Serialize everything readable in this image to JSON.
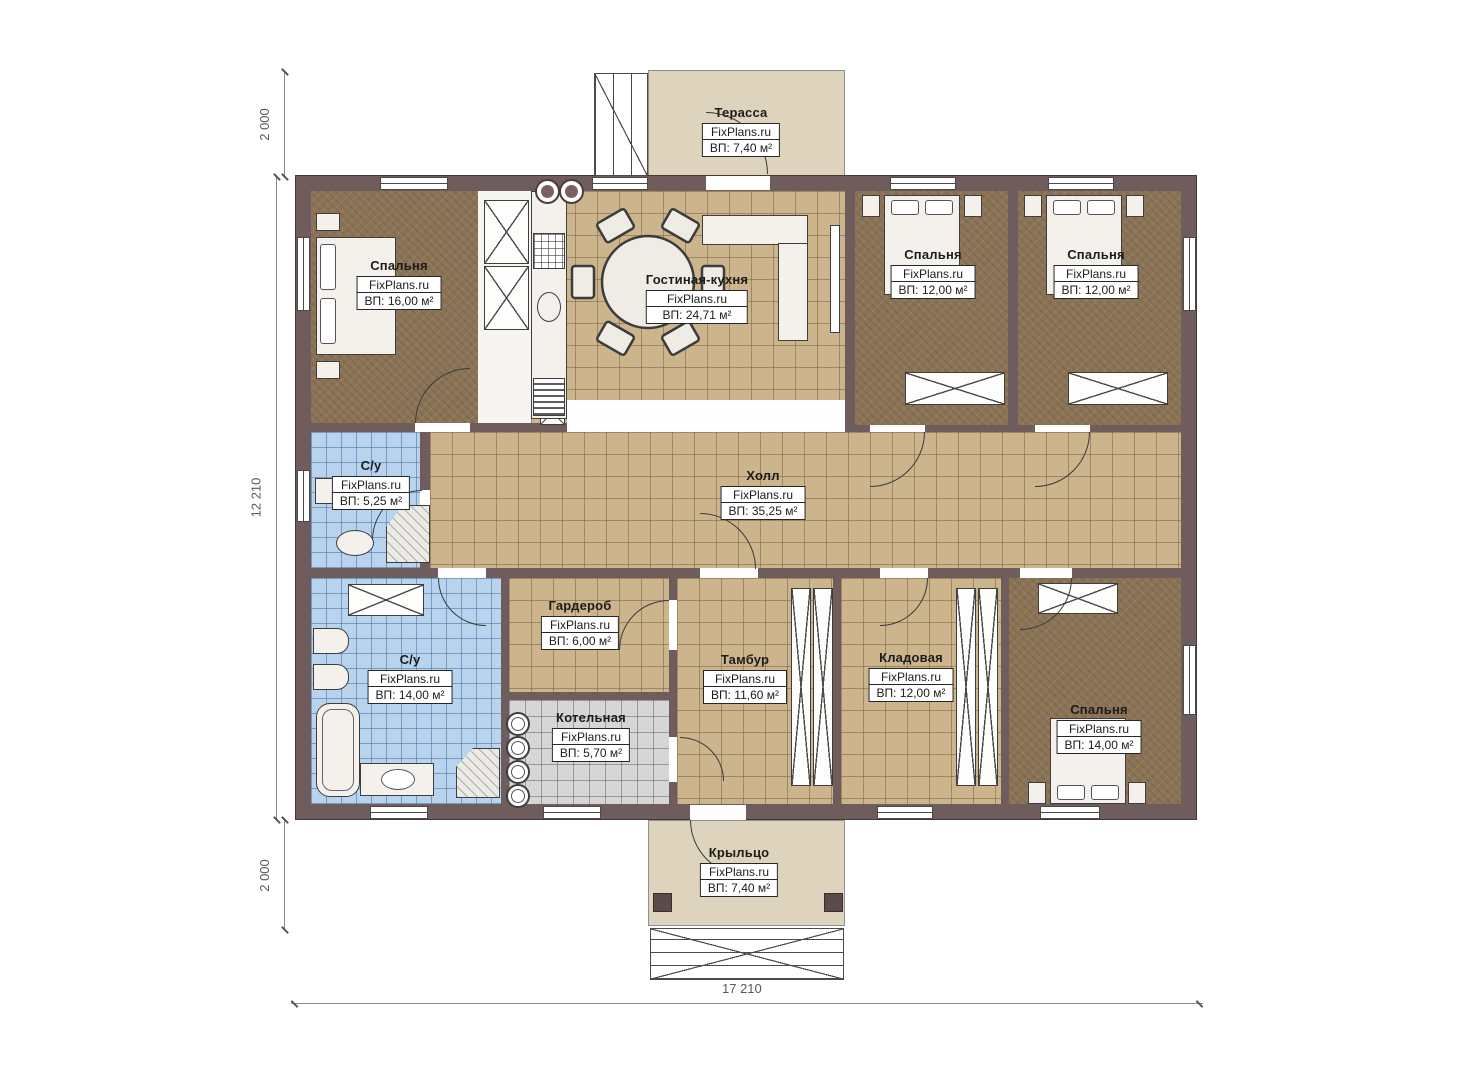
{
  "brand": "FixPlans.ru",
  "rooms": [
    {
      "id": "terrace",
      "name": "Терасса",
      "area": "ВП: 7,40 м²"
    },
    {
      "id": "bedroom-tl",
      "name": "Спальня",
      "area": "ВП: 16,00 м²"
    },
    {
      "id": "living-kitchen",
      "name": "Гостиная-кухня",
      "area": "ВП: 24,71 м²"
    },
    {
      "id": "bedroom-t1",
      "name": "Спальня",
      "area": "ВП: 12,00 м²"
    },
    {
      "id": "bedroom-t2",
      "name": "Спальня",
      "area": "ВП: 12,00 м²"
    },
    {
      "id": "hall",
      "name": "Холл",
      "area": "ВП: 35,25 м²"
    },
    {
      "id": "bath-small",
      "name": "С/у",
      "area": "ВП: 5,25 м²"
    },
    {
      "id": "bath-big",
      "name": "С/у",
      "area": "ВП: 14,00 м²"
    },
    {
      "id": "wardrobe",
      "name": "Гардероб",
      "area": "ВП: 6,00 м²"
    },
    {
      "id": "boiler",
      "name": "Котельная",
      "area": "ВП: 5,70 м²"
    },
    {
      "id": "vestibule",
      "name": "Тамбур",
      "area": "ВП: 11,60 м²"
    },
    {
      "id": "storage",
      "name": "Кладовая",
      "area": "ВП: 12,00 м²"
    },
    {
      "id": "bedroom-br",
      "name": "Спальня",
      "area": "ВП: 14,00 м²"
    },
    {
      "id": "porch",
      "name": "Крыльцо",
      "area": "ВП: 7,40 м²"
    }
  ],
  "dimensions": {
    "left_top": "2 000",
    "left_middle": "12 210",
    "left_bottom": "2 000",
    "bottom": "17 210"
  },
  "colors": {
    "wall": "#6f5c5c",
    "floor_wood": "#8b7355",
    "floor_tile_tan": "#ccb48c",
    "floor_tile_blue": "#b7d3ee",
    "floor_tile_gray": "#d6d6d6",
    "terrace": "#ded3bc"
  }
}
